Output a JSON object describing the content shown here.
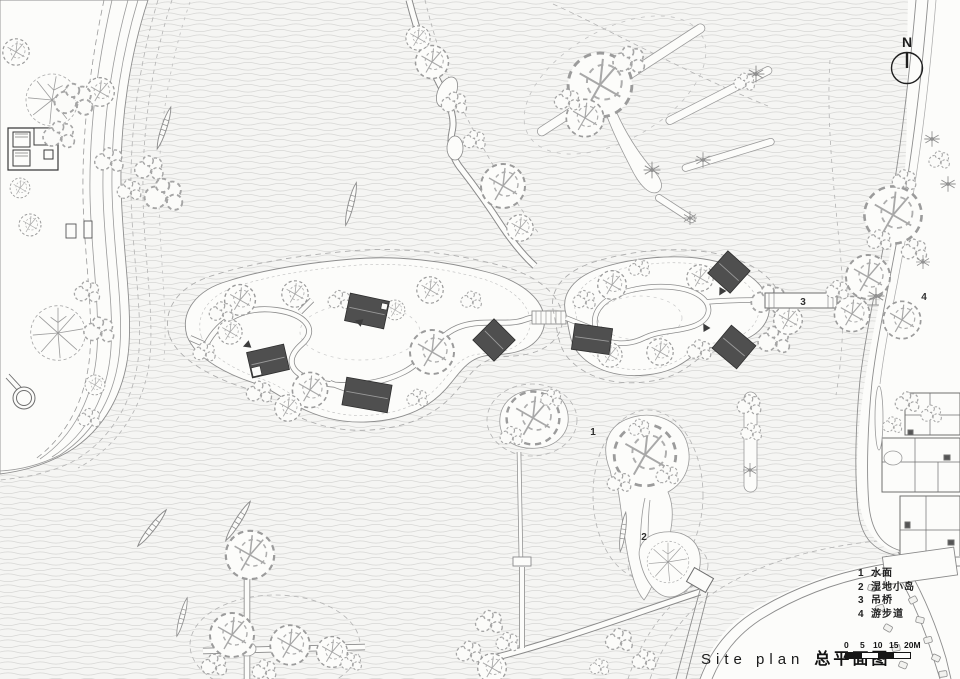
{
  "drawing": {
    "title_en": "Site plan",
    "title_zh": "总平面图",
    "north_label": "N",
    "legend": {
      "items": [
        {
          "num": "1",
          "label": "水面"
        },
        {
          "num": "2",
          "label": "湿地小岛"
        },
        {
          "num": "3",
          "label": "吊桥"
        },
        {
          "num": "4",
          "label": "游步道"
        }
      ]
    },
    "scale_bar": {
      "ticks": [
        "0",
        "5",
        "10",
        "15",
        "20M"
      ]
    },
    "plan_labels": {
      "water": "1",
      "islet": "2",
      "bridge": "3",
      "trail": "4"
    },
    "colors": {
      "paper": "#f5f5f3",
      "water_line": "#d7d7d5",
      "drawing_line": "#8d8d8d",
      "roof_dark": "#4f4f4f",
      "text": "#1d1d1d"
    }
  }
}
